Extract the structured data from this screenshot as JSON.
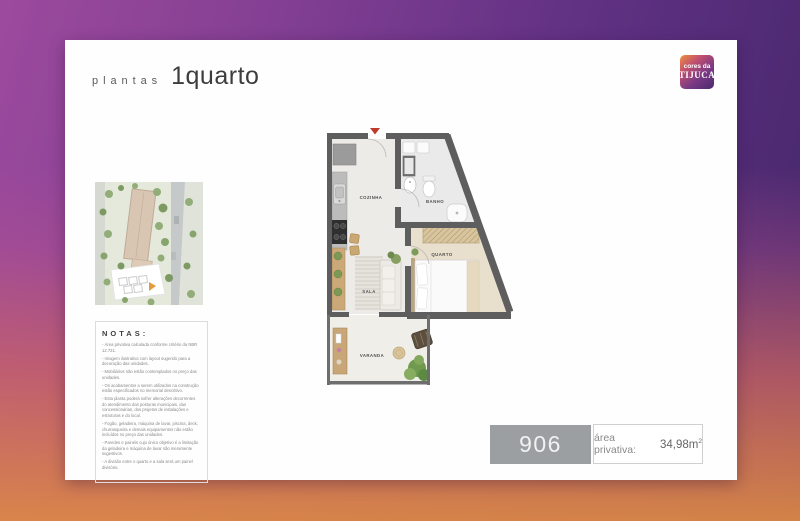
{
  "header": {
    "kicker": "plantas",
    "title": "1quarto"
  },
  "logo": {
    "top": "cores da",
    "bottom": "TIJUCA"
  },
  "floor_plan": {
    "rooms": {
      "kitchen": "COZINHA",
      "bath": "BANHO",
      "bedroom": "QUARTO",
      "living": "SALA",
      "balcony": "VARANDA"
    }
  },
  "notes": {
    "heading": "NOTAS:",
    "items": [
      "- Área privativa calculada conforme critério da NBR 12.721.",
      "- Imagem ilustrativa com layout sugerido para a decoração das unidades.",
      "- Mobiliários não estão contemplados no preço das unidades.",
      "- Os acabamentos a serem utilizados na construção estão especificados no memorial descritivo.",
      "- Esta planta poderá sofrer alterações decorrentes do atendimento das posturas municipais, das concessionárias, dos projetos de instalações e estruturas e do local.",
      "- Fogão, geladeira, máquina de lavar, piscina, deck, churrasqueira e demais equipamentos não estão incluídos no preço das unidades.",
      "- Paredes e painéis cujo único objetivo é a limitação da geladeira e máquina de lavar são meramente sugestivos.",
      "- A divisão entre o quarto e a sala será um painel divisório."
    ]
  },
  "unit": {
    "number": "906",
    "area_label": "área privativa:",
    "area_value": "34,98m",
    "area_exponent": "2"
  },
  "colors": {
    "bg_purple": "#8b4397",
    "bg_dark_purple": "#44276a",
    "bg_orange": "#df8a44",
    "bg_rose": "#c4686f",
    "unit_box_gray": "#9b9fa2",
    "entry_marker_red": "#c0392b",
    "wall_gray": "#5e5e5e",
    "bedroom_floor": "#e8dfcc",
    "wood": "#cba877"
  }
}
